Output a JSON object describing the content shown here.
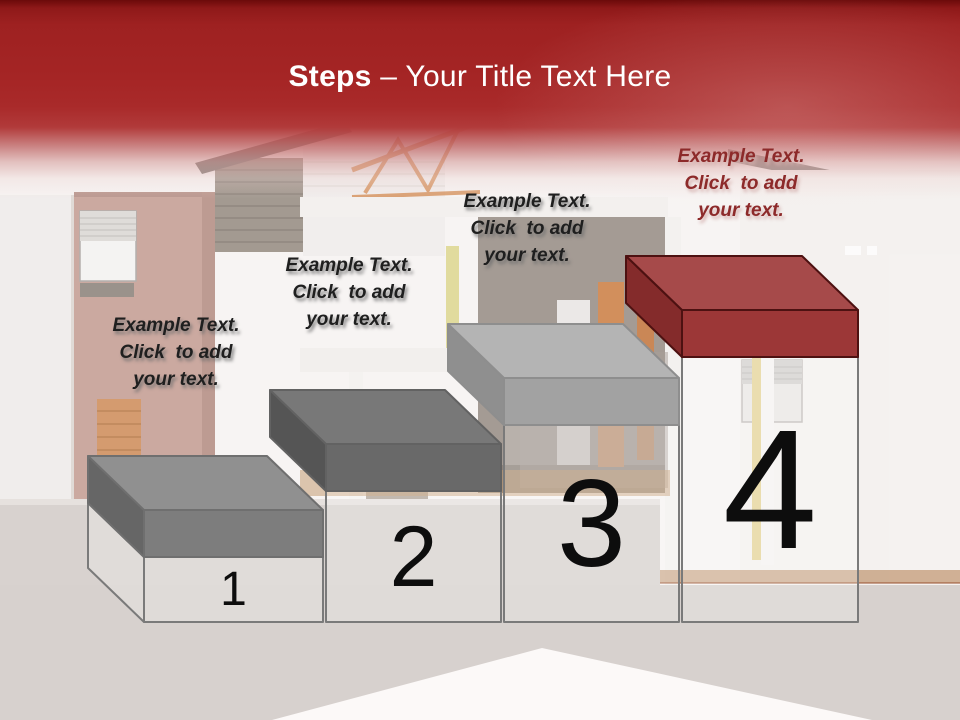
{
  "slide": {
    "title": {
      "bold": "Steps",
      "rest": " – Your Title Text Here"
    },
    "accent_color": "#a32424"
  },
  "styles": {
    "title_color": "#ffffff",
    "number_color": "#0d0d0d",
    "pedestal_outline": "#7a7a7a"
  },
  "steps": [
    {
      "number": "1",
      "label_lines": [
        "Example Text.",
        "Click  to add",
        "your text."
      ],
      "label_color": "#1f1f1f",
      "slab": {
        "top": "#909090",
        "front": "#7d7d7d",
        "side": "#666666",
        "outline": "#6f6f6f"
      }
    },
    {
      "number": "2",
      "label_lines": [
        "Example Text.",
        "Click  to add",
        "your text."
      ],
      "label_color": "#1f1f1f",
      "slab": {
        "top": "#787878",
        "front": "#696969",
        "side": "#555555",
        "outline": "#626262"
      }
    },
    {
      "number": "3",
      "label_lines": [
        "Example Text.",
        "Click  to add",
        "your text."
      ],
      "label_color": "#1f1f1f",
      "slab": {
        "top": "#b4b4b4",
        "front": "#a2a2a2",
        "side": "#8f8f8f",
        "outline": "#8e8e8e"
      }
    },
    {
      "number": "4",
      "label_lines": [
        "Example Text.",
        "Click  to add",
        "your text."
      ],
      "label_color": "#8d2a2a",
      "slab": {
        "top": "#a64a4a",
        "front": "#9c3737",
        "side": "#842b2b",
        "outline": "#4d1111"
      }
    }
  ]
}
